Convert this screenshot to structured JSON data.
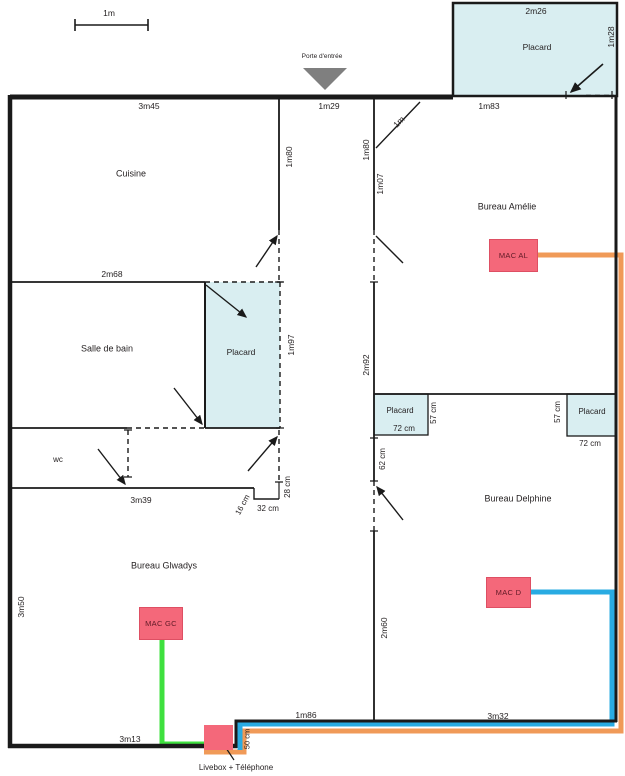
{
  "colors": {
    "wall": "#1a1a1a",
    "closet_fill": "#d9eef1",
    "device_fill": "#f4687a",
    "cable_orange": "#f09a58",
    "cable_blue": "#29abe2",
    "cable_green": "#3ee03e",
    "entrance_arrow": "#7f7f7f"
  },
  "scale_bar": {
    "label": "1m"
  },
  "entrance": {
    "label": "Porte d'entrée"
  },
  "rooms": {
    "cuisine": "Cuisine",
    "salle_de_bain": "Salle de bain",
    "wc": "wc",
    "bureau_glwadys": "Bureau Glwadys",
    "bureau_amelie": "Bureau Amélie",
    "bureau_delphine": "Bureau Delphine"
  },
  "closets": {
    "top_right_label": "Placard",
    "bathroom_label": "Placard",
    "hall_left_label": "Placard",
    "hall_right_label": "Placard"
  },
  "devices": {
    "mac_al": "MAC AL",
    "mac_gc": "MAC GC",
    "mac_d": "MAC D",
    "livebox_label": "Livebox + Téléphone"
  },
  "dimensions": {
    "kitchen_top": "3m45",
    "entry_width": "1m29",
    "tr_closet_front": "1m83",
    "tr_closet_width": "2m26",
    "tr_closet_depth": "1m28",
    "wall_a_length": "1m80",
    "wall_b_upper": "1m80",
    "wall_b_lower": "1m07",
    "entry_door_width": "1m",
    "bathroom_wall": "2m68",
    "bathroom_closet_depth": "1m97",
    "corridor_upper": "2m92",
    "wc_wall": "3m39",
    "nook_side": "16 cm",
    "nook_width": "32 cm",
    "nook_depth": "28 cm",
    "hall_closet_left_width": "72 cm",
    "hall_closet_left_depth": "57 cm",
    "hall_closet_right_depth": "57 cm",
    "hall_closet_right_width": "72 cm",
    "corridor_gap": "62 cm",
    "corridor_lower": "2m60",
    "left_wall": "3m50",
    "bottom_left_wall": "3m13",
    "bottom_mid_wall": "1m86",
    "bottom_right_wall": "3m32",
    "step_depth": "50 cm"
  }
}
